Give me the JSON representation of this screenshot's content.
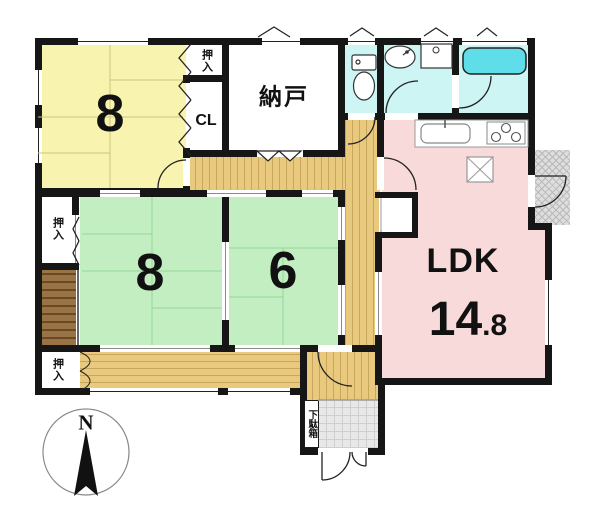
{
  "plan": {
    "rooms": {
      "western_room": {
        "size_label": "8"
      },
      "nando": {
        "label": "納戸"
      },
      "closet_top": {
        "label": "押入"
      },
      "closet_cl": {
        "label": "CL"
      },
      "tatami_8": {
        "size_label": "8"
      },
      "tatami_6": {
        "size_label": "6"
      },
      "closet_middle": {
        "label": "押入"
      },
      "closet_south": {
        "label": "押入"
      },
      "ldk": {
        "label": "LDK",
        "size_int": "14",
        "size_frac": ".8"
      },
      "shoe_cabinet": {
        "label": "下駄箱"
      }
    },
    "compass": {
      "label": "N"
    },
    "colors": {
      "wall": "#161616",
      "western_room_yellow": "#f8f3ae",
      "tatami_green": "#c2eec2",
      "ldk_pink": "#f9dada",
      "wet_area_cyan": "#cdf5f3",
      "bathtub_cyan": "#5fdde8",
      "hallway_wood": "#e9c97e",
      "tokonoma_brown": "#9a7344",
      "porch_gray": "#dedede",
      "entrance_tile": "#e8e8e8"
    }
  }
}
